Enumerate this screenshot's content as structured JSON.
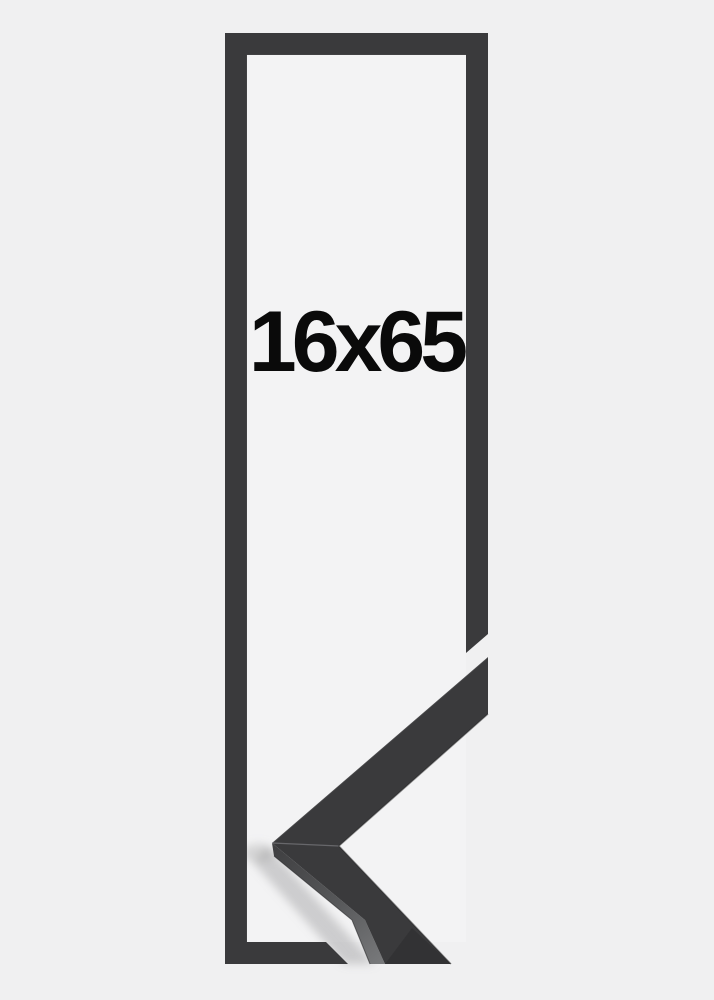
{
  "product": {
    "size_label": "16x65"
  },
  "colors": {
    "bg_outer": "#f0f0f1",
    "bg_inner": "#f3f3f4",
    "frame_color": "#3a3a3c",
    "frame_color_dark": "#323234",
    "side_face_light": "#717274",
    "text_color": "#0a0a0a"
  }
}
